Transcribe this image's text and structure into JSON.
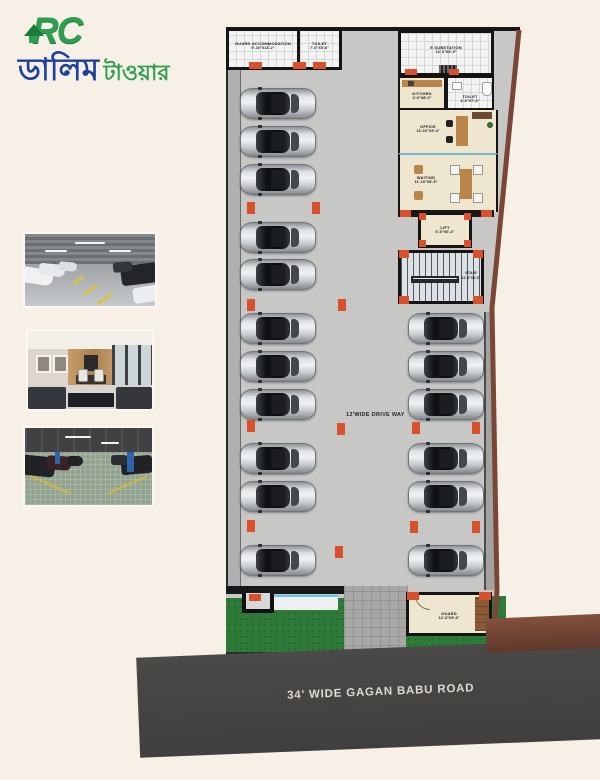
{
  "logo": {
    "prefix": "RC",
    "title_blue": "ডালিম",
    "title_green": "টাওয়ার"
  },
  "plan": {
    "rooms": {
      "guard_accommodation": {
        "label": "GUARD ACCOMMODATION",
        "dims": "9'-10\"X13'-2\""
      },
      "toilet_top": {
        "label": "TOILET",
        "dims": "7'-0\"X5'-6\""
      },
      "e_substation": {
        "label": "E SUBSTATION",
        "dims": "13'-3\"X8'-9\""
      },
      "kitchen": {
        "label": "KITCHEN",
        "dims": "4'-0\"X8'-0\""
      },
      "toilet_right": {
        "label": "TOILET",
        "dims": "4'-0\"X7'-0\""
      },
      "office": {
        "label": "OFFICE",
        "dims": "13'-10\"X9'-4\""
      },
      "waiting": {
        "label": "WAITING",
        "dims": "11'-10\"X8'-9\""
      },
      "lift": {
        "label": "LIFT",
        "dims": "6'-0\"X6'-4\""
      },
      "stair": {
        "label": "STAIR",
        "dims": "11'-3\"X8'-3\""
      },
      "guard": {
        "label": "GUARD",
        "dims": "12'-3\"X9'-6\""
      }
    },
    "driveway_label": "12'WIDE DRIVE WAY",
    "car_x_left": 240,
    "car_x_right": 408,
    "cars_left_y": [
      88,
      126,
      164,
      222,
      259,
      313,
      351,
      389,
      443,
      481,
      545
    ],
    "cars_right_y": [
      313,
      351,
      389,
      443,
      481,
      545
    ],
    "markers": [
      [
        247,
        202
      ],
      [
        312,
        202
      ],
      [
        247,
        299
      ],
      [
        338,
        299
      ],
      [
        247,
        420
      ],
      [
        337,
        423
      ],
      [
        247,
        520
      ],
      [
        335,
        546
      ],
      [
        412,
        422
      ],
      [
        472,
        422
      ],
      [
        410,
        521
      ],
      [
        472,
        521
      ]
    ]
  },
  "road": {
    "label": "34' WIDE GAGAN BABU ROAD"
  },
  "colors": {
    "background": "#f6f0e6",
    "floor": "#c7c7c6",
    "column_accent": "#d9502c",
    "lawn": "#2e7b39",
    "road": "#454443",
    "boundary": "#7b4636",
    "logo_blue": "#1d3f9e",
    "logo_green": "#2f9e4f"
  }
}
